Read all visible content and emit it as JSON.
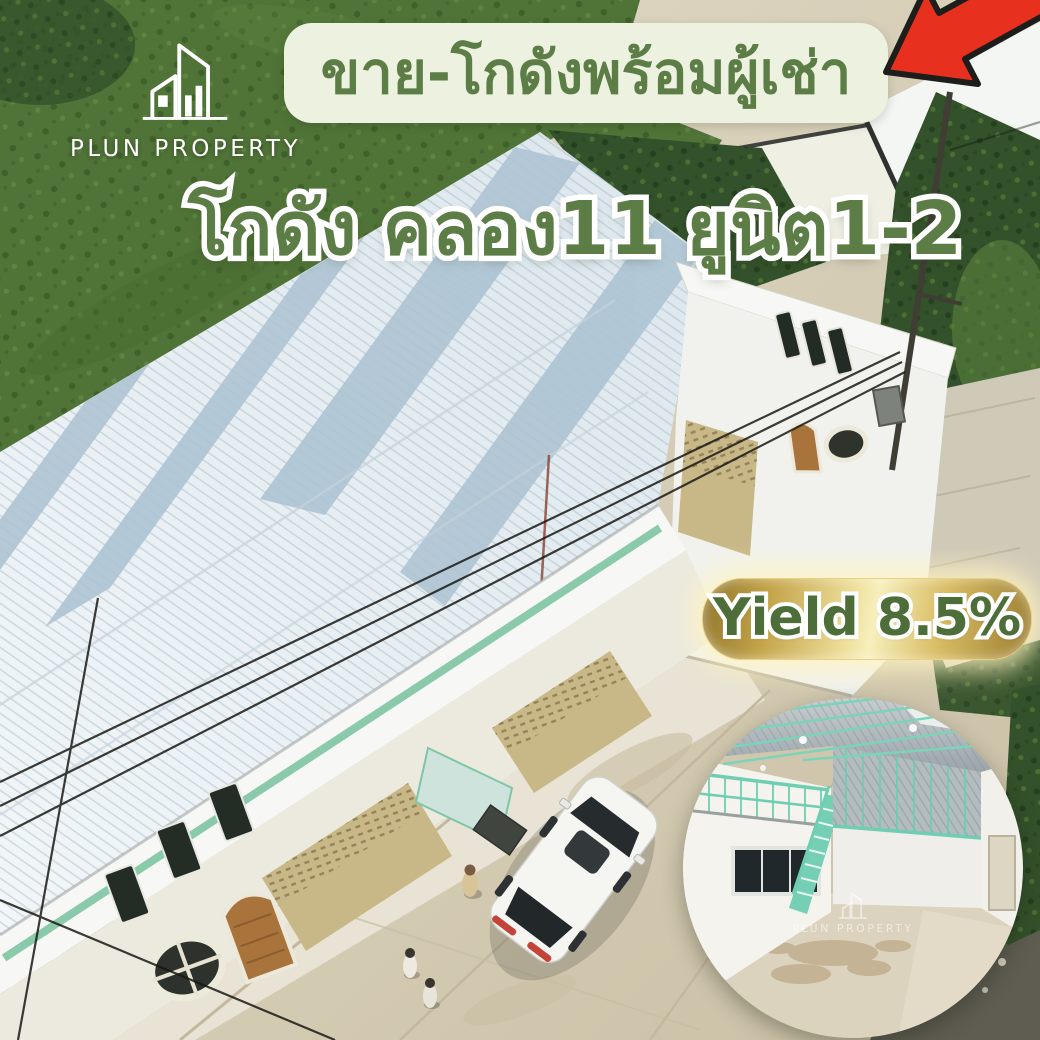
{
  "brand": {
    "name": "PLUN PROPERTY",
    "watermark": "PLUN PROPERTY"
  },
  "banner": {
    "text": "ขาย-โกดังพร้อมผู้เช่า"
  },
  "headline": {
    "text": "โกดัง คลอง11 ยูนิต1-2"
  },
  "badge": {
    "text": "Yield 8.5%"
  },
  "icons": {
    "logo": "building-outline-icon",
    "arrow": "red-arrow-icon",
    "watermark": "building-outline-icon"
  },
  "colors": {
    "text_green": "#5d7d46",
    "banner_bg": "#ecf1e0",
    "badge_text_green": "#4d6e38",
    "gold_light": "#f7efbc",
    "gold_dark": "#9a7d31",
    "arrow_red": "#e8301f",
    "outline_white": "#ffffff",
    "roof_white": "#eef3f6",
    "skylight_stripe": "#aec4d3",
    "structure_teal": "#7bd4b8",
    "wall_beige": "#c8b787",
    "door_brown": "#a8743c",
    "grass_green": "#507437"
  }
}
